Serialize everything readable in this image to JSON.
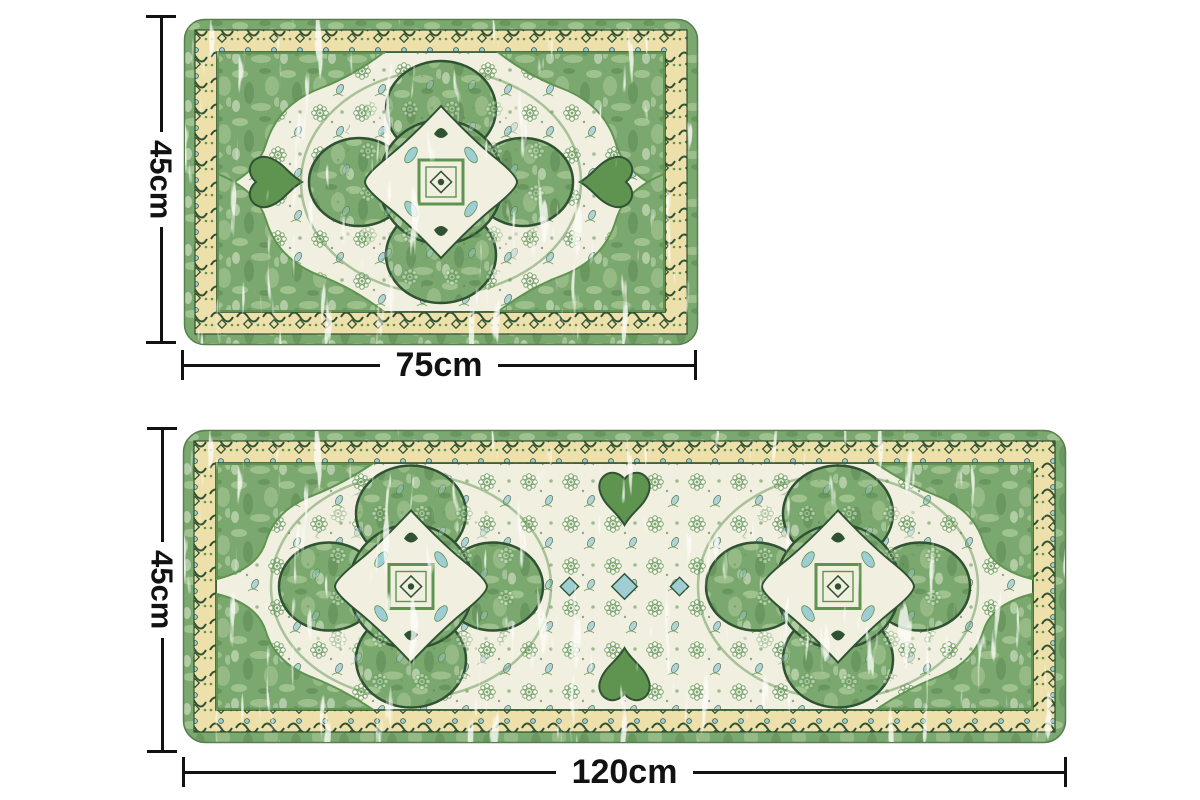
{
  "page": {
    "background_color": "#ffffff"
  },
  "diagram": {
    "type": "product-dimensions",
    "mats": [
      {
        "id": "small-mat",
        "height_label": "45cm",
        "width_label": "75cm"
      },
      {
        "id": "runner-mat",
        "height_label": "45cm",
        "width_label": "120cm"
      }
    ]
  },
  "colors": {
    "dimension_color": "#121212",
    "rug_green": "#7aa86e",
    "rug_green_light": "#a6c795",
    "rug_green_deep": "#5a8450",
    "rug_green_mid": "#5f9450",
    "rug_green_dark": "#2f5233",
    "rug_pale": "#dfe9d2",
    "border_cream": "#eee0ab",
    "field_cream": "#f1efe0",
    "accent_teal": "#9ecdd3"
  }
}
